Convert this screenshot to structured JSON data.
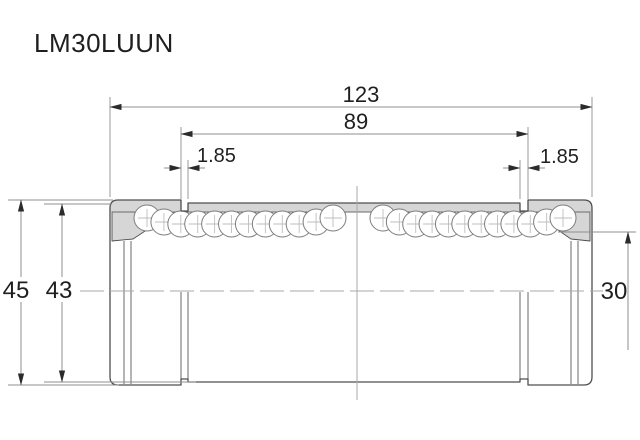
{
  "title": "LM30LUUN",
  "labels": {
    "overall_length": "123",
    "groove_spacing": "89",
    "groove_width_left": "1.85",
    "groove_width_right": "1.85",
    "outer_diameter": "45",
    "groove_outer_diameter": "43",
    "bore_diameter": "30"
  },
  "colors": {
    "background": "#ffffff",
    "body_outline": "#4f4f4f",
    "section_fill": "#d6d6d6",
    "dimension_line": "#8f8f8f",
    "centerline": "#a8a8a8",
    "arrow": "#2b2b2b",
    "text": "#1f1f1f"
  },
  "ball_rows": [
    {
      "name": "left",
      "start": 147,
      "end": 333,
      "count": 12,
      "cy": 224,
      "r": 13
    },
    {
      "name": "right",
      "start": 383,
      "end": 563,
      "count": 12,
      "cy": 224,
      "r": 13
    }
  ],
  "ball_lift_profile": [
    6,
    2,
    0,
    0,
    0,
    0,
    0,
    0,
    0,
    0,
    2,
    6
  ]
}
